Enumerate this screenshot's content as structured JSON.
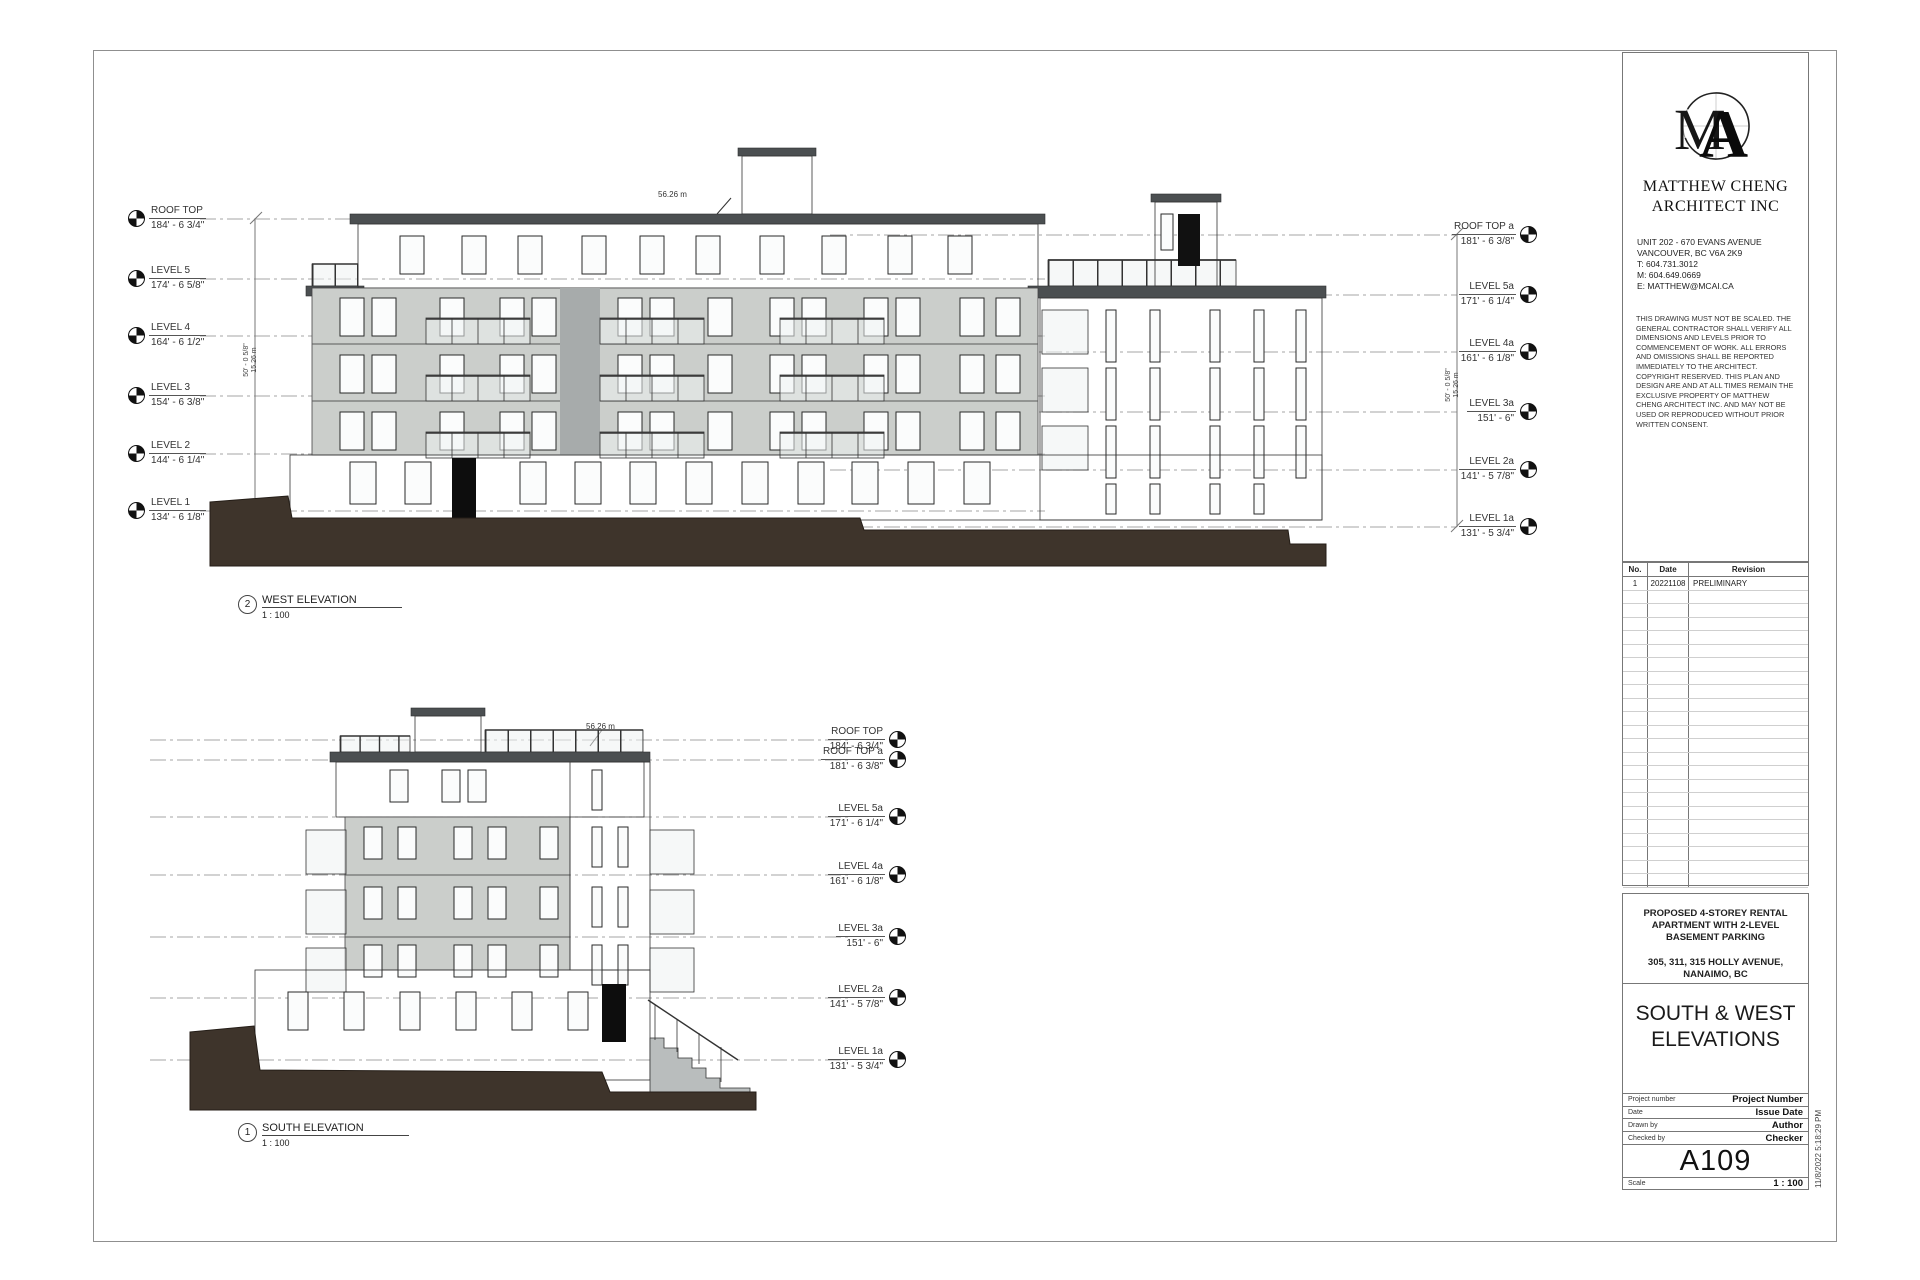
{
  "sheet": {
    "firm": {
      "logo": "ma-monogram",
      "name_line1": "MATTHEW CHENG",
      "name_line2": "ARCHITECT INC",
      "address_lines": [
        "UNIT 202 - 670 EVANS AVENUE",
        "VANCOUVER, BC  V6A 2K9",
        "T: 604.731.3012",
        "M: 604.649.0669",
        "E: MATTHEW@MCAI.CA"
      ],
      "disclaimer": "THIS DRAWING MUST NOT BE SCALED. THE GENERAL CONTRACTOR SHALL VERIFY ALL DIMENSIONS AND LEVELS PRIOR TO COMMENCEMENT OF WORK. ALL ERRORS AND OMISSIONS SHALL BE REPORTED IMMEDIATELY TO THE ARCHITECT. COPYRIGHT RESERVED. THIS PLAN AND DESIGN ARE AND AT ALL TIMES REMAIN THE EXCLUSIVE PROPERTY OF MATTHEW CHENG ARCHITECT INC. AND MAY NOT BE USED OR REPRODUCED WITHOUT PRIOR WRITTEN CONSENT."
    },
    "revision_table": {
      "headers": [
        "No.",
        "Date",
        "Revision"
      ],
      "rows": [
        {
          "no": "1",
          "date": "20221108",
          "revision": "PRELIMINARY"
        }
      ],
      "empty_row_count": 22
    },
    "project": {
      "title": "PROPOSED 4-STOREY RENTAL APARTMENT WITH 2-LEVEL BASEMENT PARKING",
      "address": "305, 311, 315 HOLLY AVENUE, NANAIMO, BC",
      "sheet_title_line1": "SOUTH & WEST",
      "sheet_title_line2": "ELEVATIONS"
    },
    "title_block": {
      "project_number_label": "Project number",
      "project_number": "Project Number",
      "date_label": "Date",
      "date": "Issue Date",
      "drawn_by_label": "Drawn by",
      "drawn_by": "Author",
      "checked_by_label": "Checked by",
      "checked_by": "Checker",
      "sheet_number": "A109",
      "scale_label": "Scale",
      "scale": "1 : 100",
      "print_timestamp": "11/8/2022 5:18:29 PM"
    }
  },
  "west_elevation": {
    "viewport_number": "2",
    "title": "WEST ELEVATION",
    "scale": "1 : 100",
    "roof_height_annotation": "56.26 m",
    "left_levels": [
      {
        "name": "ROOF TOP",
        "elevation": "184' - 6 3/4\""
      },
      {
        "name": "LEVEL 5",
        "elevation": "174' - 6 5/8\""
      },
      {
        "name": "LEVEL 4",
        "elevation": "164' - 6 1/2\""
      },
      {
        "name": "LEVEL 3",
        "elevation": "154' - 6 3/8\""
      },
      {
        "name": "LEVEL 2",
        "elevation": "144' - 6 1/4\""
      },
      {
        "name": "LEVEL 1",
        "elevation": "134' - 6 1/8\""
      }
    ],
    "right_levels": [
      {
        "name": "ROOF TOP a",
        "elevation": "181' - 6 3/8\""
      },
      {
        "name": "LEVEL 5a",
        "elevation": "171' - 6 1/4\""
      },
      {
        "name": "LEVEL 4a",
        "elevation": "161' - 6 1/8\""
      },
      {
        "name": "LEVEL 3a",
        "elevation": "151' - 6\""
      },
      {
        "name": "LEVEL 2a",
        "elevation": "141' - 5 7/8\""
      },
      {
        "name": "LEVEL 1a",
        "elevation": "131' - 5 3/4\""
      }
    ],
    "overall_dim": {
      "imperial": "50' - 0 5/8\"",
      "metric": "15.26 m"
    }
  },
  "south_elevation": {
    "viewport_number": "1",
    "title": "SOUTH ELEVATION",
    "scale": "1 : 100",
    "roof_height_annotation": "56.26 m",
    "right_levels": [
      {
        "name": "ROOF TOP",
        "elevation": "184' - 6 3/4\""
      },
      {
        "name": "ROOF TOP a",
        "elevation": "181' - 6 3/8\""
      },
      {
        "name": "LEVEL 5a",
        "elevation": "171' - 6 1/4\""
      },
      {
        "name": "LEVEL 4a",
        "elevation": "161' - 6 1/8\""
      },
      {
        "name": "LEVEL 3a",
        "elevation": "151' - 6\""
      },
      {
        "name": "LEVEL 2a",
        "elevation": "141' - 5 7/8\""
      },
      {
        "name": "LEVEL 1a",
        "elevation": "131' - 5 3/4\""
      }
    ]
  },
  "colors": {
    "siding_dark": "#737777",
    "siding_base": "#6b6f70",
    "stucco_light": "#cbcecb",
    "roof_slab": "#4b4f51",
    "earth": "#3e342b",
    "glass": "#eef2f2"
  }
}
